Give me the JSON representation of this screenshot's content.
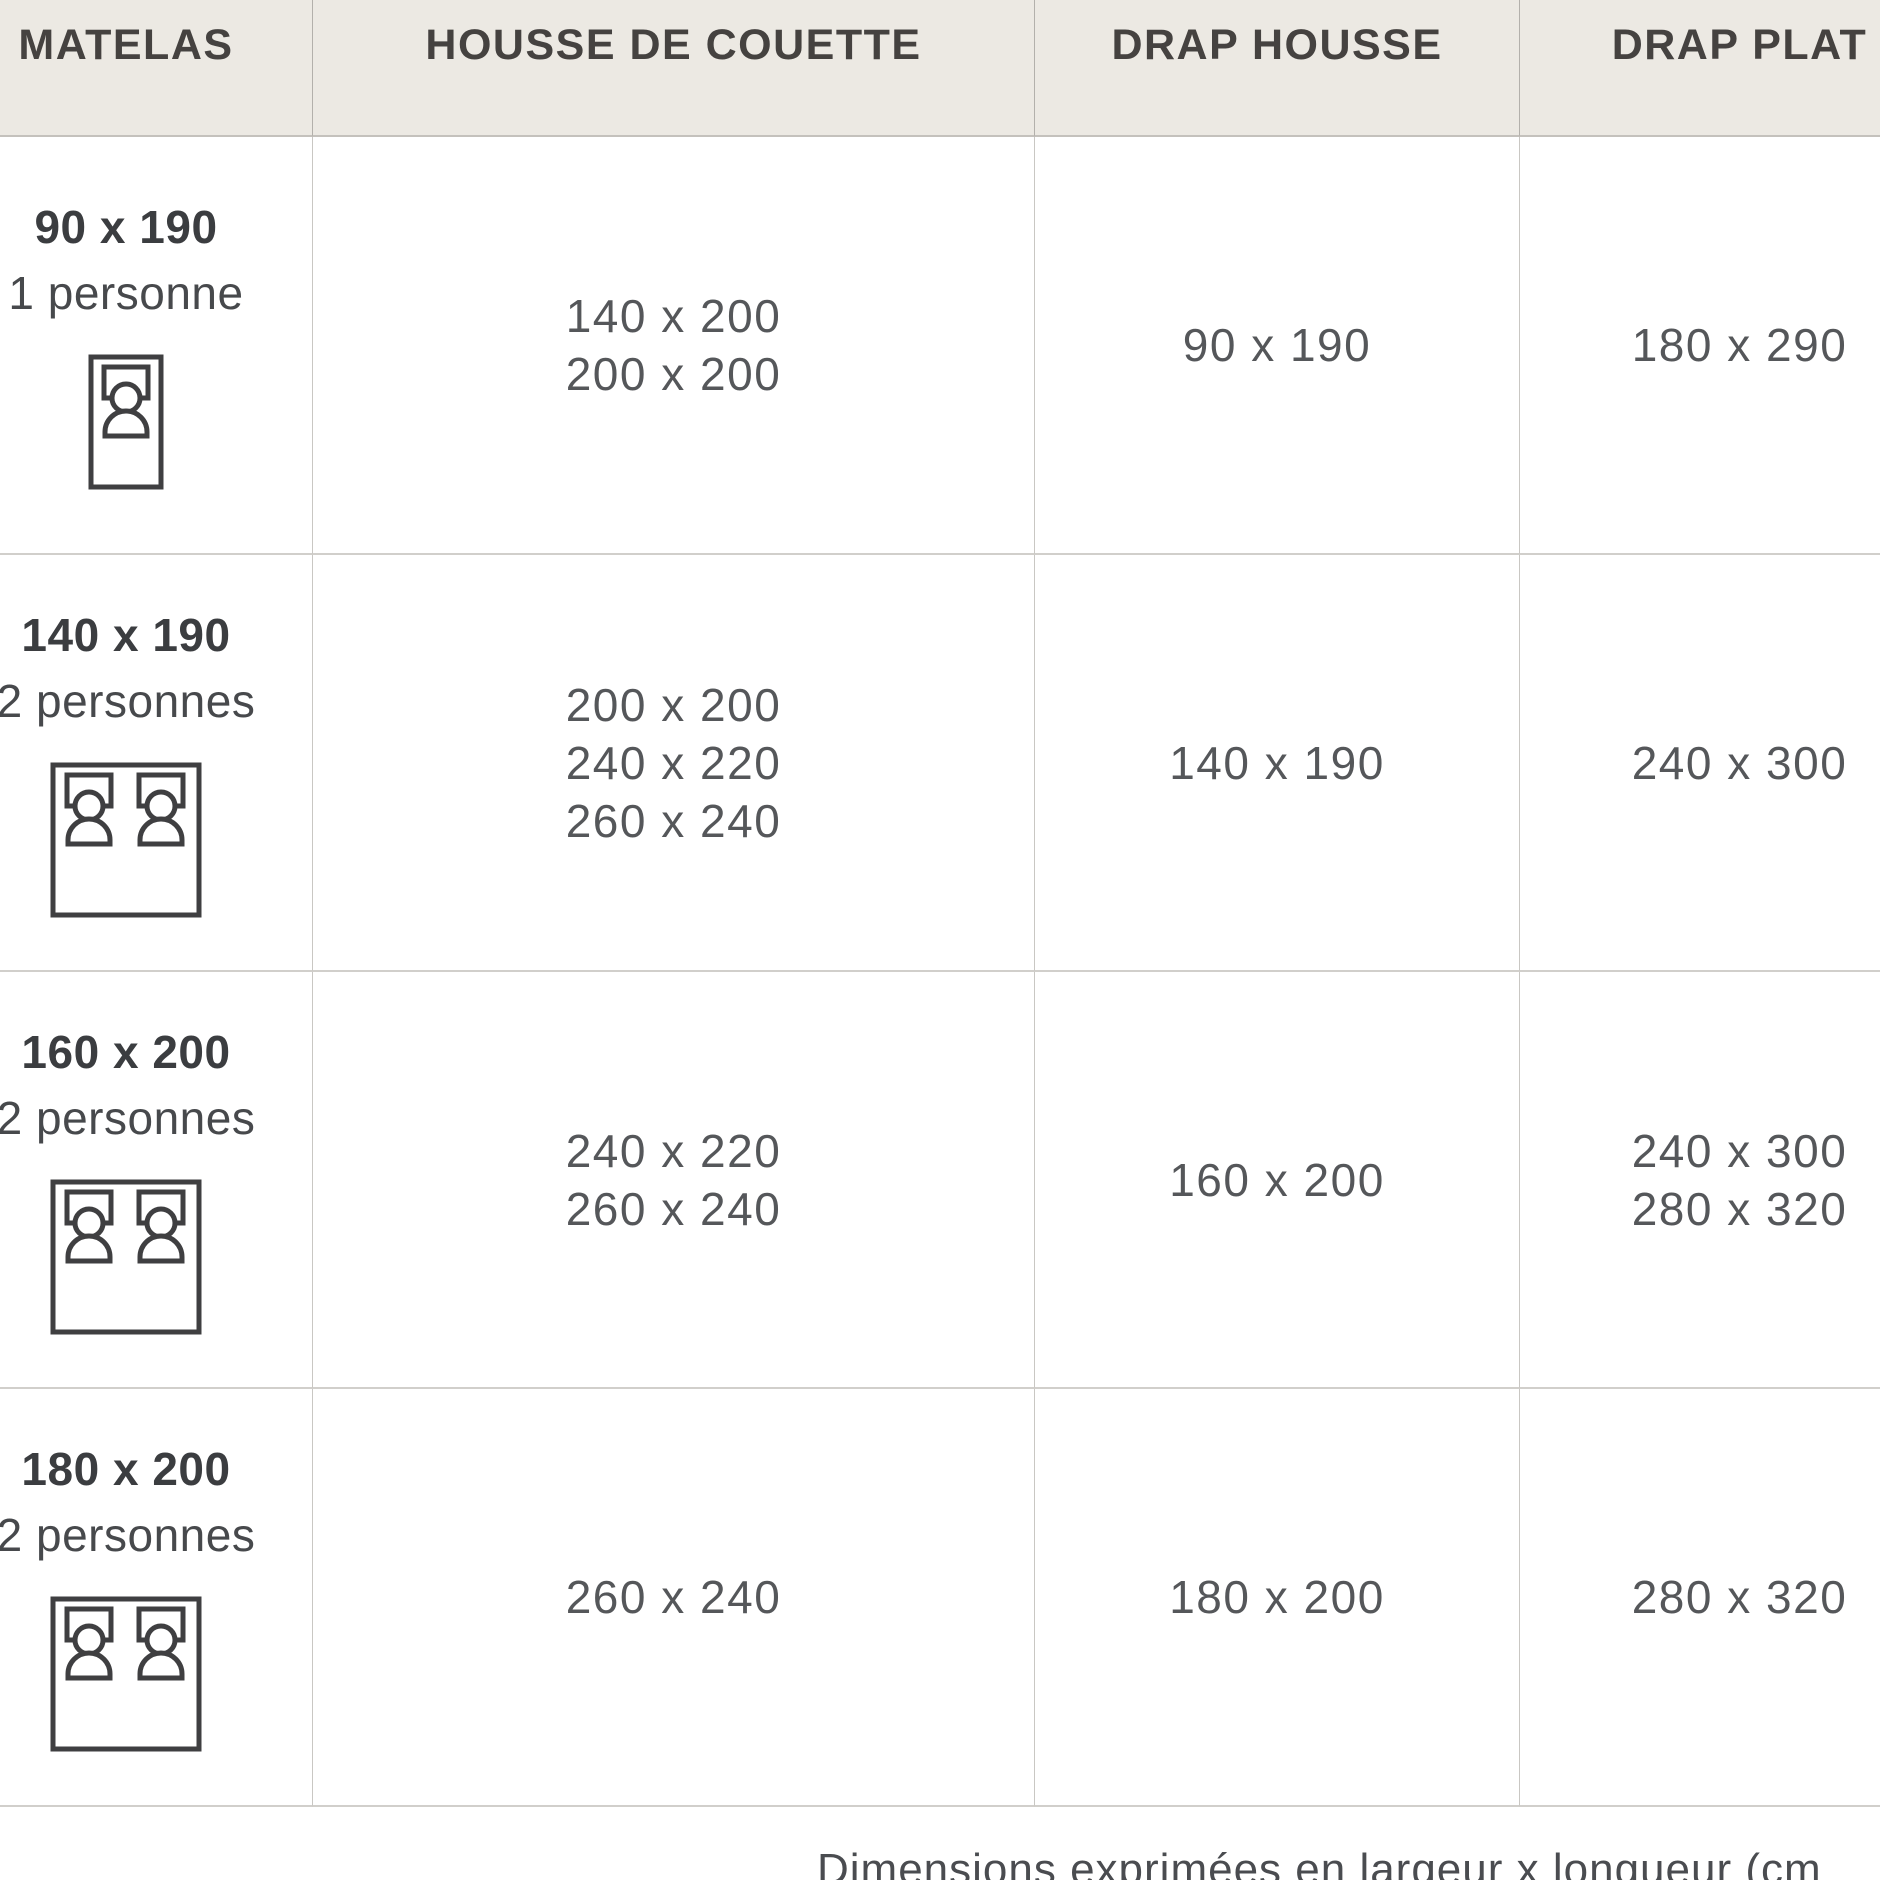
{
  "table": {
    "columns": [
      "MATELAS",
      "HOUSSE DE COUETTE",
      "DRAP HOUSSE",
      "DRAP PLAT"
    ],
    "rows": [
      {
        "mattress_size": "90 x 190",
        "capacity": "1 personne",
        "bed_icon": "single-bed-icon",
        "housse_de_couette": [
          "140 x 200",
          "200 x 200"
        ],
        "drap_housse": [
          "90 x 190"
        ],
        "drap_plat": [
          "180 x 290"
        ]
      },
      {
        "mattress_size": "140 x 190",
        "capacity": "2 personnes",
        "bed_icon": "double-bed-icon",
        "housse_de_couette": [
          "200 x 200",
          "240 x 220",
          "260 x 240"
        ],
        "drap_housse": [
          "140 x 190"
        ],
        "drap_plat": [
          "240 x 300"
        ]
      },
      {
        "mattress_size": "160 x 200",
        "capacity": "2 personnes",
        "bed_icon": "double-bed-icon",
        "housse_de_couette": [
          "240 x 220",
          "260 x 240"
        ],
        "drap_housse": [
          "160 x 200"
        ],
        "drap_plat": [
          "240 x 300",
          "280 x 320"
        ]
      },
      {
        "mattress_size": "180 x 200",
        "capacity": "2 personnes",
        "bed_icon": "double-bed-icon",
        "housse_de_couette": [
          "260 x 240"
        ],
        "drap_housse": [
          "180 x 200"
        ],
        "drap_plat": [
          "280 x 320"
        ]
      }
    ]
  },
  "footer": {
    "note": "Dimensions exprimées en largeur x longueur (cm"
  },
  "colors": {
    "header_background": "#ECE9E3",
    "header_text": "#454240",
    "body_text": "#55575A",
    "bold_text": "#3B3D40",
    "grid_line": "#C9C7C3",
    "icon_stroke": "#3F3F41"
  }
}
